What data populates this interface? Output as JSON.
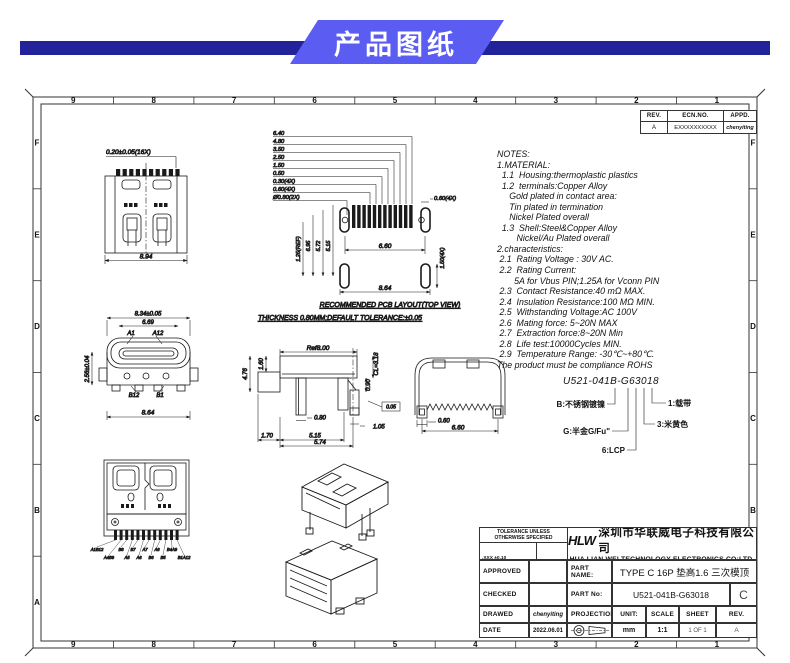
{
  "colors": {
    "banner": "#5a5cf2",
    "bar": "#22229a"
  },
  "header": {
    "title": "产品图纸"
  },
  "sheet": {
    "cols": [
      "9",
      "8",
      "7",
      "6",
      "5",
      "4",
      "3",
      "2",
      "1"
    ],
    "rows": [
      "F",
      "E",
      "D",
      "C",
      "B",
      "A"
    ]
  },
  "rev_table": {
    "headers": [
      "REV.",
      "ECN.NO.",
      "APPD."
    ],
    "row": [
      "A",
      "EXXXXXXXXXX",
      "chenyiting"
    ]
  },
  "notes": {
    "lines": [
      "NOTES:",
      "1.MATERIAL:",
      "  1.1  Housing:thermoplastic plastics",
      "  1.2  terminals:Copper Alloy",
      "     Gold plated in contact area:",
      "     Tin plated in termination",
      "     Nickel Plated overall",
      "  1.3  Shell:Steel&Copper Alloy",
      "        Nickel/Au Plated overall",
      "2.characteristics:",
      " 2.1  Rating Voltage : 30V AC.",
      " 2.2  Rating Current:",
      "       5A for Vbus PIN;1.25A for Vconn PIN",
      " 2.3  Contact Resistance:40 mΩ MAX.",
      " 2.4  Insulation Resistance:100 MΩ MIN.",
      " 2.5  Withstanding Voltage:AC 100V",
      " 2.6  Mating force: 5~20N MAX",
      " 2.7  Extraction force:8~20N Min",
      " 2.8  Life test:10000Cycles MIN.",
      " 2.9  Temperature Range: -30℃~+80℃.",
      "The product must be compliance ROHS"
    ]
  },
  "part_code": {
    "number": "U521-041B-G63018",
    "labels": {
      "b": "B:不锈钢镀镍",
      "g": "G:半金G/Fu\"",
      "lcp": "6:LCP",
      "tape": "1:载带",
      "color": "3:米黄色"
    }
  },
  "dims": {
    "topview": {
      "pitch": "0.20±0.05(16X)",
      "width": "8.94"
    },
    "pcb": {
      "stack": [
        "6.40",
        "4.80",
        "3.50",
        "2.50",
        "1.50",
        "0.50",
        "0.30(4X)",
        "0.60(4X)",
        "Ø0.80(2X)"
      ],
      "oval_w": "0.60(4X)",
      "left": [
        "1.25(REF)",
        "6.95",
        "5.72",
        "5.15"
      ],
      "span": "6.60",
      "right": "1.50(4X)",
      "width": "8.64",
      "caption1": "RECOMMENDED PCB LAYOUT(TOP VIEW)",
      "caption2": "THICKNESS 0.80MM;DEFAULT TOLERANCE:±0.05"
    },
    "front": {
      "w1": "8.34±0.05",
      "w2": "6.69",
      "a1": "A1",
      "a12": "A12",
      "b12": "B12",
      "b1": "B1",
      "h": "2.56±0.04",
      "w3": "8.64"
    },
    "side": {
      "ref": "Ref8.00",
      "cl": "CL=3.18",
      "d160": "1.60",
      "d476": "4.76",
      "d090": "0.90",
      "d080": "0.80",
      "d105": "1.05",
      "d170": "1.70",
      "d515": "5.15",
      "d574": "5.74",
      "flag": "0.05"
    },
    "rear": {
      "d060": "0.60",
      "d660": "6.60"
    },
    "bottom": {
      "row1": [
        "A1B12",
        "B8",
        "B7",
        "A7",
        "A8",
        "B4A9"
      ],
      "row2": [
        "A4B9",
        "A5",
        "A6",
        "B6",
        "B5",
        "B1A12"
      ]
    }
  },
  "title_block": {
    "tolerance": {
      "header1": "TOLERANCE UNLESS",
      "header2": "OTHERWISE SPECIFIED",
      "rows": [
        ".XXX ±0.10",
        ".XX  ±0.20",
        ".X   ±0.30"
      ],
      "ang": [
        "X°  ±3°",
        ".X°  ±2°"
      ]
    },
    "company": {
      "logo": "HLW",
      "name_cn": "深圳市华联威电子科技有限公司",
      "name_en": "HUA LIAN WEI TECHNOLOGY ELECTRONICS CO;LTD."
    },
    "approved_label": "APPROVED",
    "checked_label": "CHECKED",
    "drawed_label": "DRAWED",
    "date_label": "DATE",
    "drawed_value": "chenyiting",
    "date_value": "2022.06.01",
    "part_name_label": "PART NAME:",
    "part_name": "TYPE C 16P 垫高1.6 三次模顶",
    "part_no_label": "PART No:",
    "part_no": "U521-041B-G63018",
    "rev_letter": "C",
    "projection_label": "PROJECTION:",
    "unit_label": "UNIT:",
    "unit": "mm",
    "scale_label": "SCALE",
    "scale": "1:1",
    "sheet_label": "SHEET",
    "sheet": "1 OF 1",
    "rev_label": "REV.",
    "rev": "A"
  }
}
